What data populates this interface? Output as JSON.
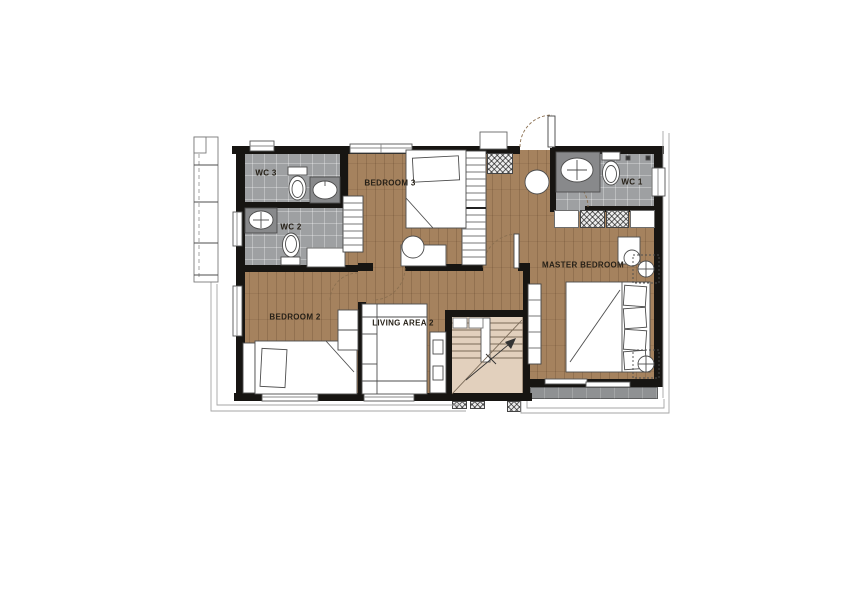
{
  "rooms": {
    "wc3": {
      "label": "WC 3"
    },
    "wc2": {
      "label": "WC 2"
    },
    "wc1": {
      "label": "WC 1"
    },
    "bedroom3": {
      "label": "BEDROOM 3"
    },
    "bedroom2": {
      "label": "BEDROOM 2"
    },
    "living_area2": {
      "label": "LIVING AREA 2"
    },
    "master_bedroom": {
      "label": "MASTER BEDROOM"
    }
  },
  "colors": {
    "wood_floor": "#a5825e",
    "tile_floor": "#9ea0a2",
    "stair_floor": "#e2d0bd",
    "balcony_floor": "#8f9193",
    "wall": "#171512",
    "furniture_outline": "#4d4d4d",
    "label_text": "#262017",
    "exterior_outline": "#a6a6a6"
  },
  "furniture": {
    "wc3": [
      "toilet",
      "sink"
    ],
    "wc2": [
      "sink",
      "toilet",
      "counter"
    ],
    "wc1": [
      "sink",
      "toilet"
    ],
    "bedroom3": [
      "single-bed",
      "desk",
      "chair",
      "wardrobe"
    ],
    "hallway": [
      "shelving-closet",
      "stool",
      "hatched-duct",
      "entry-door"
    ],
    "master_bedroom": [
      "double-bed",
      "pillows",
      "desk",
      "chair",
      "low-console",
      "wardrobe-row",
      "ac-unit",
      "ac-unit",
      "sliding-door"
    ],
    "bedroom2": [
      "single-bed",
      "shelf-unit"
    ],
    "living_area2": [
      "sofa",
      "console"
    ],
    "stairs": [
      "treads",
      "handrail",
      "direction-arrow"
    ],
    "exterior": [
      "trellis-screen",
      "balcony",
      "roof-overhang-outline"
    ]
  }
}
